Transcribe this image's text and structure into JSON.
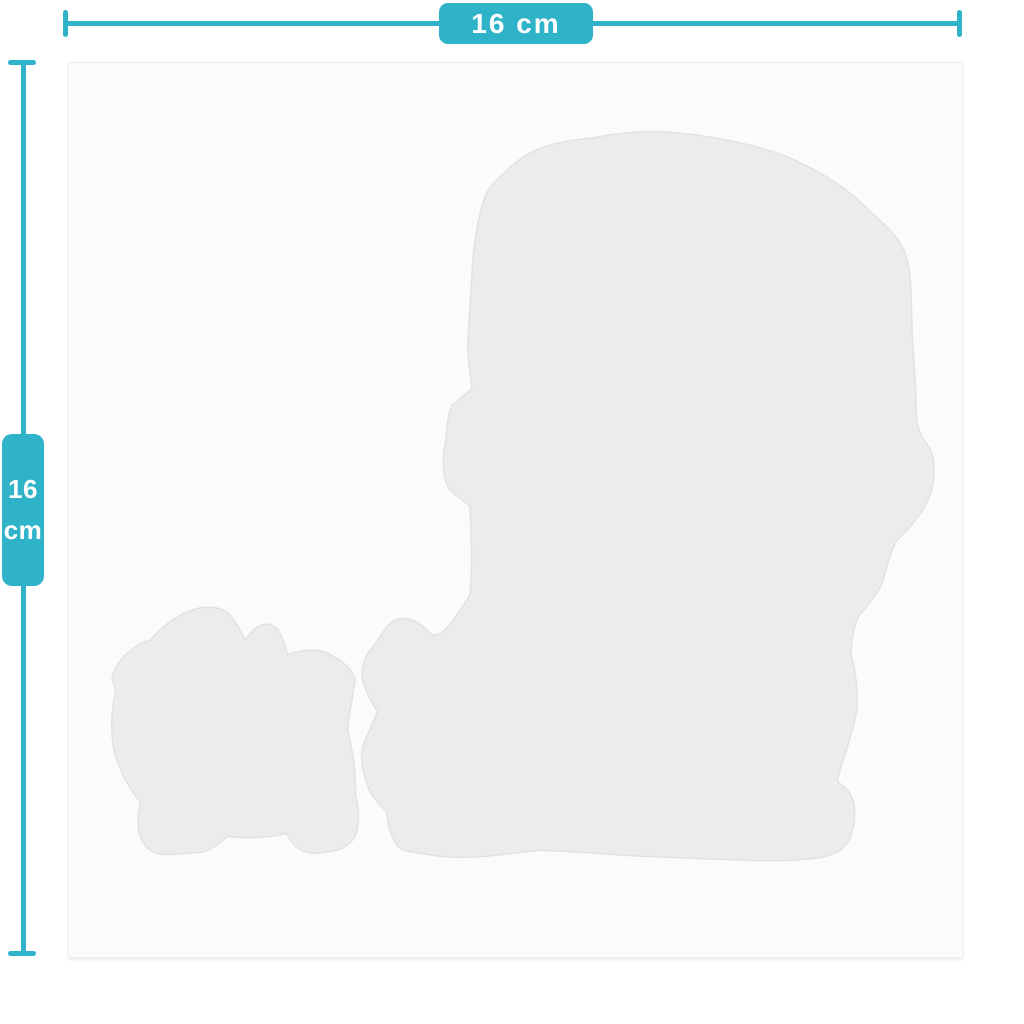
{
  "figure": {
    "type": "product-dimension-diagram",
    "width_dimension": {
      "label": "16 cm"
    },
    "height_dimension": {
      "value": "16",
      "unit": "cm"
    },
    "silhouette_count": 2
  },
  "colors": {
    "page_bg": "#ffffff",
    "accent": "#2fb3c8",
    "label_text": "#ffffff",
    "canvas_bg": "#fbfbfa",
    "canvas_border": "#ededec",
    "silhouette_fill": "#ececea",
    "silhouette_edge": "#e2e2e0"
  }
}
